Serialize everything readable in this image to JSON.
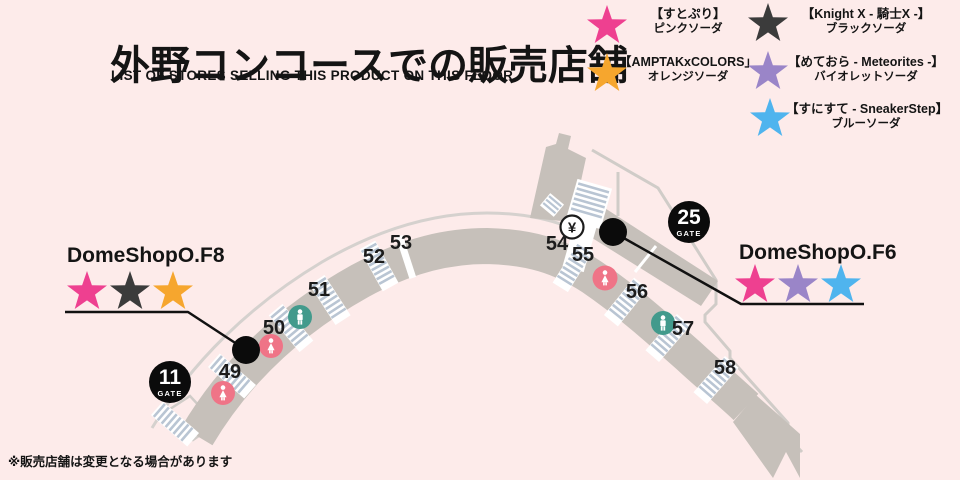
{
  "title": "外野コンコースでの販売店舗",
  "subtitle": "LIST OF STORES SELLING THIS PRODUCT ON THIS FLOOR",
  "note": "※販売店舗は変更となる場合があります",
  "legend": {
    "items": [
      {
        "group": "【すとぷり】",
        "product": "ピンクソーダ",
        "color": "#ee4090"
      },
      {
        "group": "【Knight X - 騎士X -】",
        "product": "ブラックソーダ",
        "color": "#3b3b3b"
      },
      {
        "group": "【AMPTAKxCOLORS」",
        "product": "オレンジソーダ",
        "color": "#f6a62e"
      },
      {
        "group": "【めておら - Meteorites -】",
        "product": "バイオレットソーダ",
        "color": "#9a85c8"
      },
      {
        "group": "【すにすて - SneakerStep】",
        "product": "ブルーソーダ",
        "color": "#4fb4ee"
      }
    ]
  },
  "shops": [
    {
      "name": "DomeShopO.F8",
      "star_colors": [
        "#ee4090",
        "#3b3b3b",
        "#f6a62e"
      ]
    },
    {
      "name": "DomeShopO.F6",
      "star_colors": [
        "#ee4090",
        "#9a85c8",
        "#4fb4ee"
      ]
    }
  ],
  "gates": [
    {
      "number": "11",
      "label": "GATE"
    },
    {
      "number": "25",
      "label": "GATE"
    }
  ],
  "map": {
    "sections": [
      "49",
      "50",
      "51",
      "52",
      "53",
      "54",
      "55",
      "56",
      "57",
      "58"
    ],
    "atm_symbol": "¥"
  }
}
